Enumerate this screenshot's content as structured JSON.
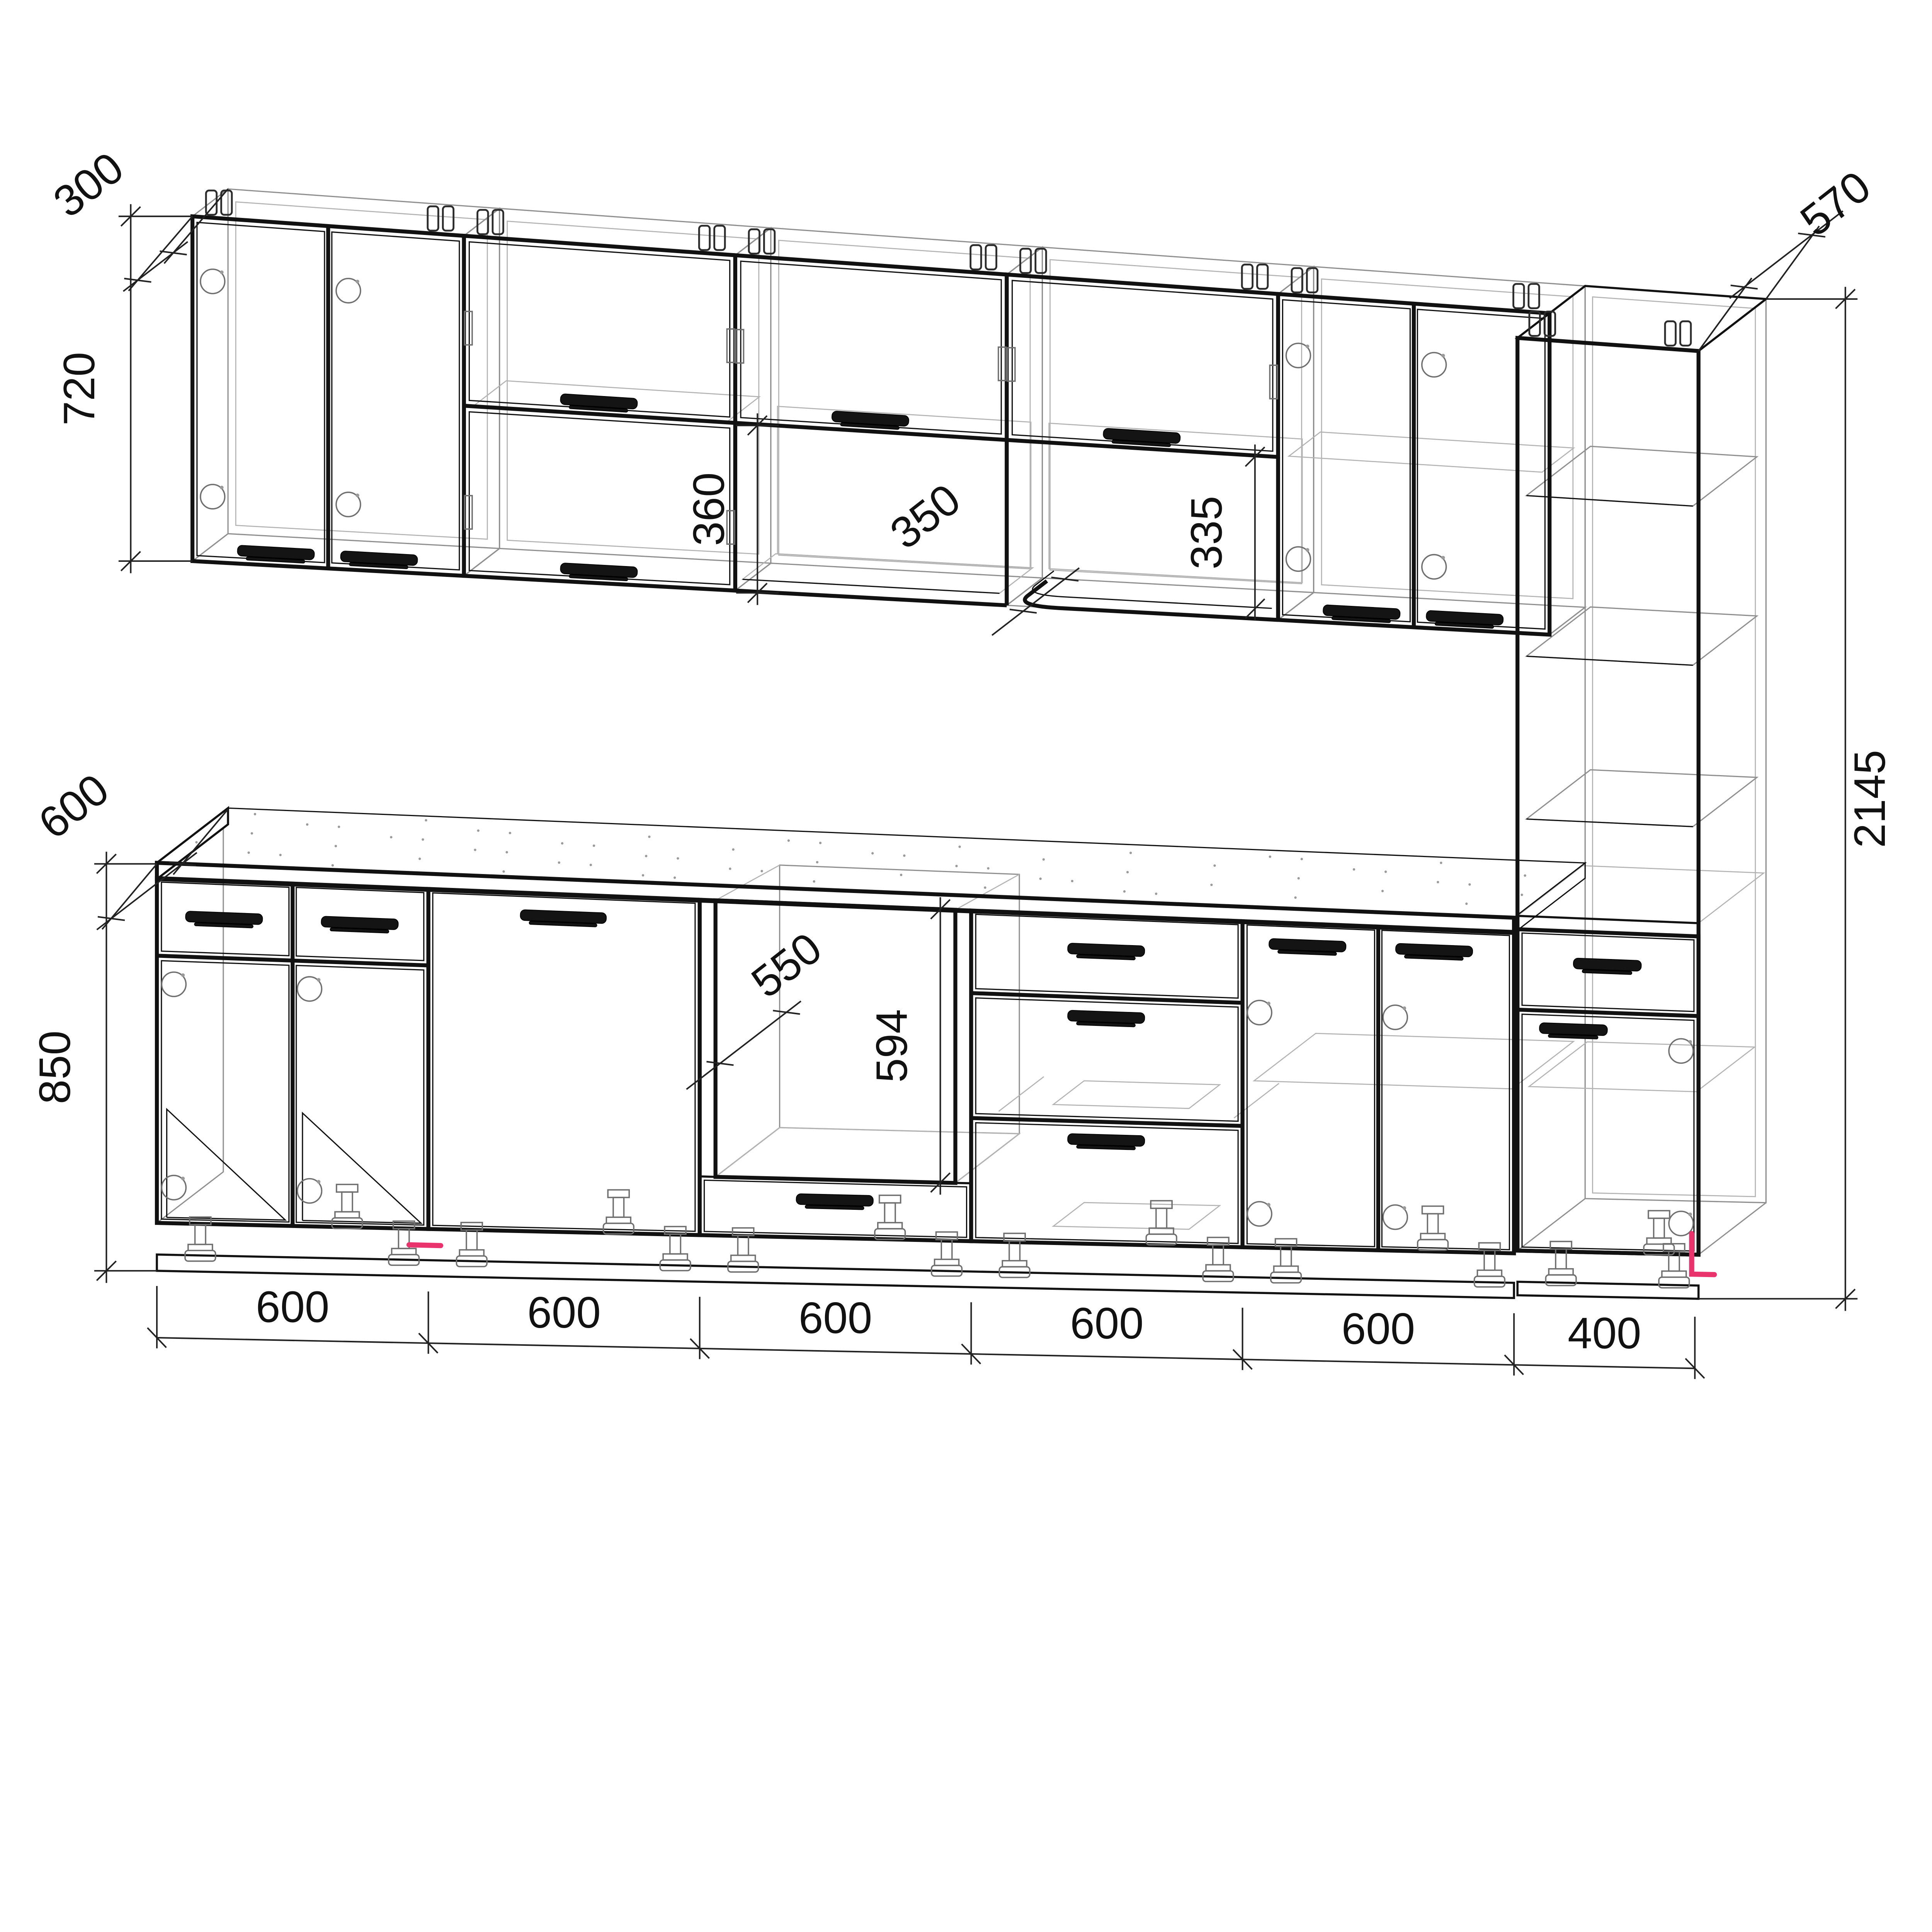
{
  "drawing": {
    "title": "kitchen-cabinet-set-technical-drawing",
    "background": "#ffffff",
    "line_color": "#111111",
    "hidden_line_color": "#8f8f8f",
    "accent_color": "#e8336d",
    "units": "mm"
  },
  "dimensions": {
    "wall_depth": "300",
    "wall_height": "720",
    "niche_height": "360",
    "niche_depth": "350",
    "open_shelf_height": "335",
    "tall_depth": "570",
    "tall_height": "2145",
    "counter_depth": "600",
    "base_height": "850",
    "oven_cavity_depth": "550",
    "oven_cavity_height": "594",
    "bottom_widths": [
      "600",
      "600",
      "600",
      "600",
      "600",
      "400"
    ]
  },
  "modules": {
    "wall_units": [
      {
        "id": "wall-cabinet-1",
        "width_mm": 600,
        "type": "two-door"
      },
      {
        "id": "wall-cabinet-2",
        "width_mm": 600,
        "type": "two-flap"
      },
      {
        "id": "wall-cabinet-3",
        "width_mm": 600,
        "type": "flap-over-open-niche"
      },
      {
        "id": "wall-cabinet-4",
        "width_mm": 600,
        "type": "flap-over-curved-shelf"
      },
      {
        "id": "wall-cabinet-5",
        "width_mm": 600,
        "type": "two-door-with-shelf"
      }
    ],
    "tall_unit": {
      "id": "tall-shelf-column",
      "width_mm": 400,
      "height_mm": 2145,
      "depth_mm": 570,
      "open_shelves": 3,
      "base_drawer": true,
      "base_door": true
    },
    "base_units": [
      {
        "id": "base-cabinet-1",
        "width_mm": 600,
        "type": "two-drawers-two-doors"
      },
      {
        "id": "base-cabinet-2",
        "width_mm": 600,
        "type": "appliance-door"
      },
      {
        "id": "base-cabinet-3",
        "width_mm": 600,
        "type": "oven-housing-drawer"
      },
      {
        "id": "base-cabinet-4",
        "width_mm": 600,
        "type": "three-drawers"
      },
      {
        "id": "base-cabinet-5",
        "width_mm": 600,
        "type": "two-doors"
      },
      {
        "id": "base-cabinet-6",
        "width_mm": 400,
        "type": "drawer-over-door"
      }
    ]
  }
}
